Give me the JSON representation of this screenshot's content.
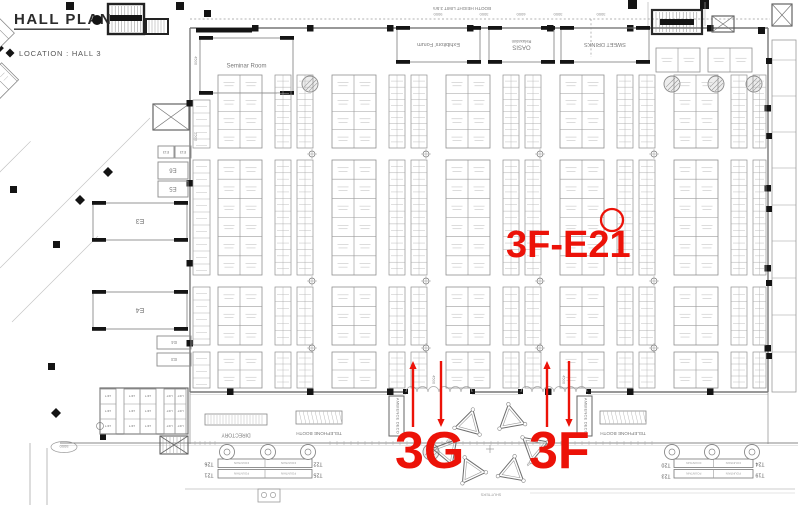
{
  "header": {
    "title": "HALL PLAN",
    "location": "LOCATION : HALL 3"
  },
  "limit_note": {
    "text": "BOOTH HEIGHT LIMIT 3.5m",
    "x": 462,
    "y": 10
  },
  "colors": {
    "red": "#ec1208",
    "wall": "#8b8b8b",
    "dark": "#141414",
    "tick": "#b9b9b9",
    "label": "#777777"
  },
  "rooms": [
    {
      "label": "Seminar Room",
      "sub": "",
      "x": 200,
      "y": 38,
      "w": 93,
      "h": 55,
      "fs": 6,
      "rot": 0
    },
    {
      "label": "Exhibitors' Forum",
      "sub": "",
      "x": 397,
      "y": 28,
      "w": 83,
      "h": 34,
      "fs": 5.5,
      "rot": 180
    },
    {
      "label": "OASIS",
      "sub": "Relaxation",
      "x": 489,
      "y": 28,
      "w": 65,
      "h": 34,
      "fs": 6,
      "rot": 180
    },
    {
      "label": "SWEET DRINKS",
      "sub": "",
      "x": 561,
      "y": 28,
      "w": 88,
      "h": 34,
      "fs": 5.5,
      "rot": 180
    },
    {
      "label": "E6",
      "sub": "",
      "x": 158,
      "y": 162,
      "w": 30,
      "h": 17,
      "fs": 6,
      "rot": 180
    },
    {
      "label": "E5",
      "sub": "",
      "x": 158,
      "y": 181,
      "w": 30,
      "h": 16,
      "fs": 6,
      "rot": 180
    },
    {
      "label": "E3",
      "sub": "",
      "x": 93,
      "y": 203,
      "w": 94,
      "h": 37,
      "fs": 7,
      "rot": 180
    },
    {
      "label": "E4",
      "sub": "",
      "x": 93,
      "y": 292,
      "w": 94,
      "h": 37,
      "fs": 7,
      "rot": 180
    },
    {
      "label": "E4",
      "sub": "",
      "x": 157,
      "y": 336,
      "w": 34,
      "h": 13,
      "fs": 4.5,
      "rot": 180
    },
    {
      "label": "E3",
      "sub": "",
      "x": 157,
      "y": 353,
      "w": 34,
      "h": 13,
      "fs": 4.5,
      "rot": 180
    },
    {
      "label": "E13",
      "sub": "",
      "x": 158,
      "y": 146,
      "w": 16,
      "h": 12,
      "fs": 3.5,
      "rot": 180
    },
    {
      "label": "E13",
      "sub": "",
      "x": 175,
      "y": 146,
      "w": 16,
      "h": 12,
      "fs": 3.5,
      "rot": 180
    }
  ],
  "lift": {
    "label": "LIFT"
  },
  "corridor": {
    "directory": "DIRECTORY",
    "telephone": "TELEPHONE BOOTH",
    "ambience": "AMBIENCE DECO",
    "shutters": "SHUTTERS"
  },
  "fountain": {
    "cell_label": "FOUNTAIN",
    "tables": [
      {
        "t": "T26",
        "x": 209,
        "y": 466
      },
      {
        "t": "T21",
        "x": 209,
        "y": 477
      },
      {
        "t": "T22",
        "x": 318,
        "y": 466
      },
      {
        "t": "T25",
        "x": 318,
        "y": 477
      },
      {
        "t": "T20",
        "x": 666,
        "y": 467
      },
      {
        "t": "T23",
        "x": 666,
        "y": 478
      },
      {
        "t": "T24",
        "x": 760,
        "y": 466
      },
      {
        "t": "T19",
        "x": 760,
        "y": 477
      }
    ]
  },
  "dims": [
    {
      "t": "9000",
      "x": 438,
      "y": 16,
      "rot": 180
    },
    {
      "t": "3000",
      "x": 484,
      "y": 16,
      "rot": 180
    },
    {
      "t": "6000",
      "x": 521,
      "y": 16,
      "rot": 180
    },
    {
      "t": "3000",
      "x": 558,
      "y": 16,
      "rot": 180
    },
    {
      "t": "3000",
      "x": 601,
      "y": 16,
      "rot": 180
    },
    {
      "t": "5000",
      "x": 64,
      "y": 448,
      "rot": 180
    },
    {
      "t": "4500",
      "x": 434,
      "y": 381,
      "rot": 90
    },
    {
      "t": "4500",
      "x": 564,
      "y": 381,
      "rot": 90
    },
    {
      "t": "4500",
      "x": 196,
      "y": 62,
      "rot": 90
    },
    {
      "t": "2500",
      "x": 196,
      "y": 138,
      "rot": 90
    },
    {
      "t": "4500",
      "x": 449,
      "y": 441,
      "rot": -45
    },
    {
      "t": "4500",
      "x": 530,
      "y": 464,
      "rot": -45
    }
  ],
  "red": {
    "booth_id": "3F-E21",
    "booth_id_x": 506,
    "booth_id_y": 257,
    "booth_id_fs": 38,
    "circle": {
      "cx": 612,
      "cy": 220,
      "r": 11
    },
    "zones": [
      {
        "t": "3G",
        "x": 395,
        "y": 468,
        "fs": 52
      },
      {
        "t": "3F",
        "x": 529,
        "y": 468,
        "fs": 52
      }
    ],
    "arrows": [
      {
        "x": 413,
        "tail": 427,
        "tip": 361,
        "dir": "up"
      },
      {
        "x": 441,
        "tail": 361,
        "tip": 427,
        "dir": "down"
      },
      {
        "x": 547,
        "tail": 427,
        "tip": 361,
        "dir": "up"
      },
      {
        "x": 569,
        "tail": 361,
        "tip": 427,
        "dir": "down"
      }
    ]
  },
  "booth_grid": {
    "x0": 218,
    "x_max": 766,
    "period": 114,
    "wide_w": 44,
    "n1_off": 57,
    "n2_off": 79,
    "narrow_w": 16,
    "bands": [
      {
        "y": 75,
        "h": 73,
        "wr": 4,
        "nr": 6
      },
      {
        "y": 160,
        "h": 115,
        "wr": 6,
        "nr": 9
      },
      {
        "y": 287,
        "h": 58,
        "wr": 3,
        "nr": 4
      },
      {
        "y": 352,
        "h": 36,
        "wr": 2,
        "nr": 3
      }
    ],
    "left_strip": {
      "x": 193,
      "w": 17,
      "cell": 13,
      "y0": 100,
      "y1": 388
    },
    "top_right_blocks": [
      {
        "x": 656,
        "y": 48,
        "w": 44,
        "h": 24
      },
      {
        "x": 708,
        "y": 48,
        "w": 44,
        "h": 24
      }
    ]
  },
  "triangles": {
    "centers": [
      [
        469,
        424
      ],
      [
        511,
        419
      ],
      [
        447,
        451
      ],
      [
        534,
        447
      ],
      [
        471,
        471
      ],
      [
        512,
        471
      ]
    ],
    "rots": [
      15,
      -10,
      40,
      70,
      -25,
      10
    ]
  }
}
